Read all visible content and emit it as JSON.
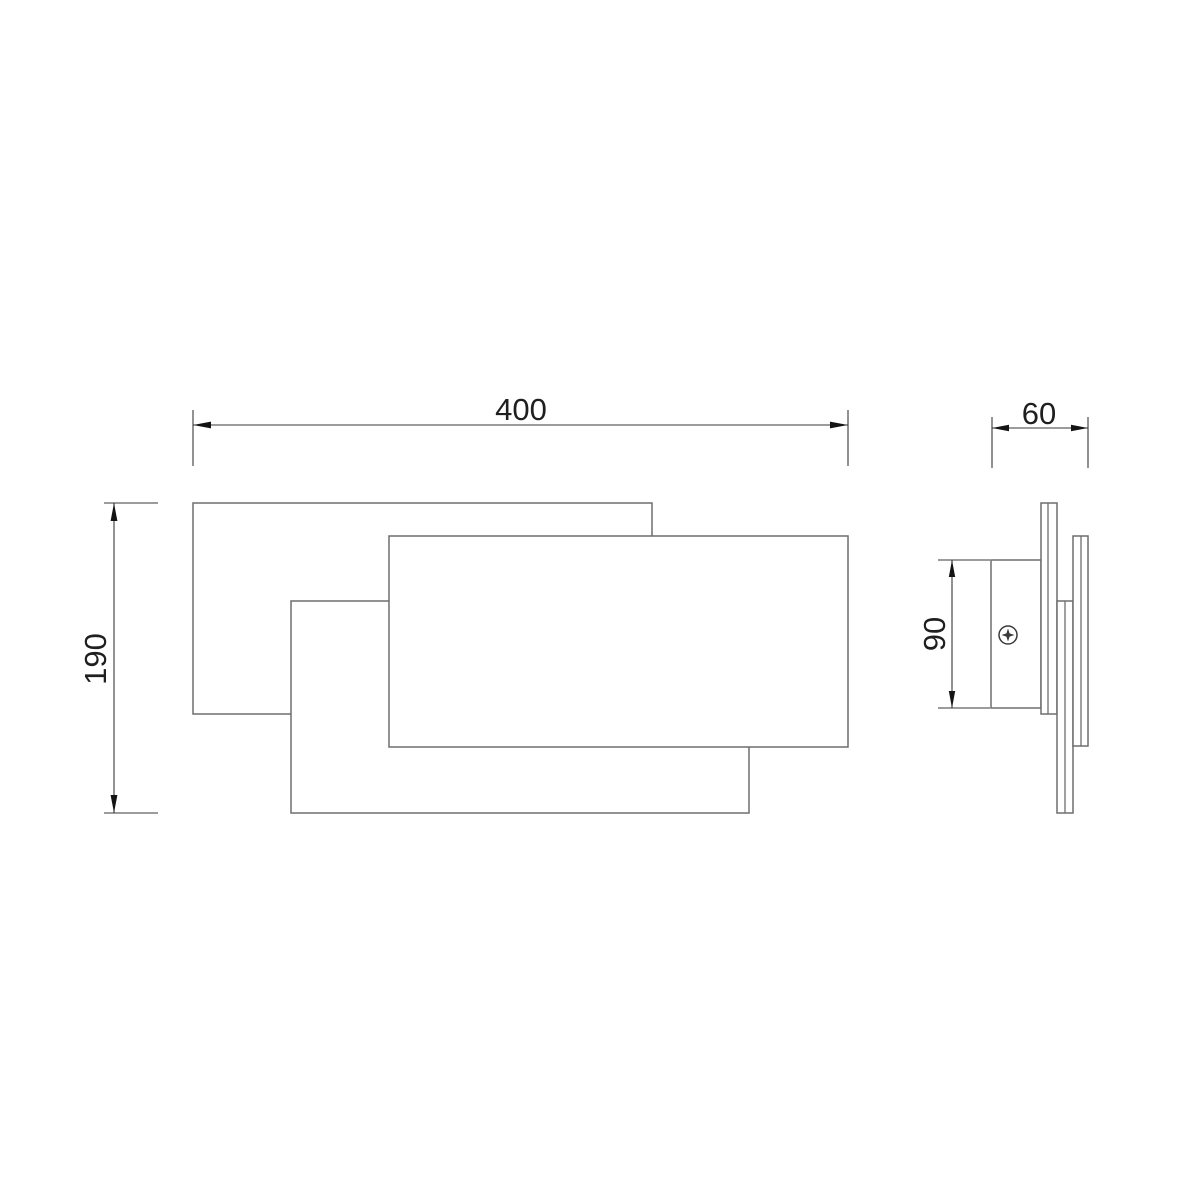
{
  "drawing": {
    "colors": {
      "background": "#ffffff",
      "object_line": "#6e6e6e",
      "dimension_line": "#3a3a3a",
      "arrow": "#141414",
      "text": "#1f1f1f"
    },
    "front_view": {
      "width_dimension": "400",
      "height_dimension": "190"
    },
    "side_view": {
      "depth_dimension": "60",
      "plate_height_dimension": "90"
    }
  }
}
